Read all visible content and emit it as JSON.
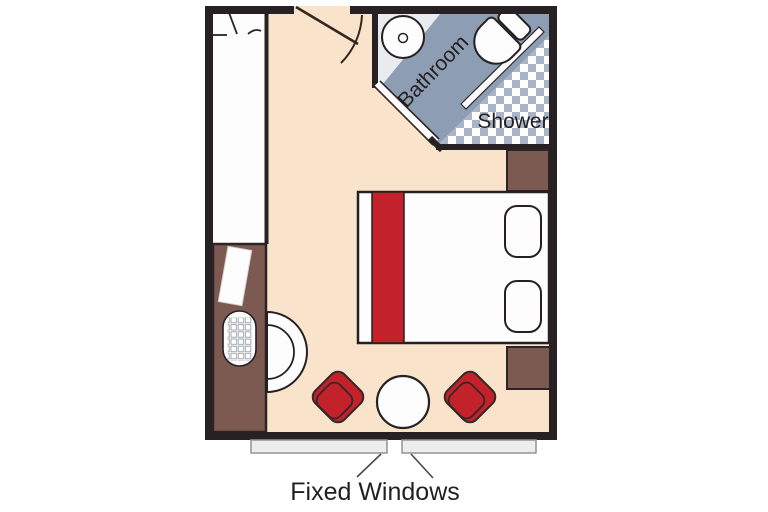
{
  "title": "Cabin floor plan",
  "labels": {
    "bathroom": "Bathroom",
    "shower": "Shower",
    "fixed_windows": "Fixed Windows"
  },
  "colors": {
    "wall": "#272123",
    "floor": "#f9e3ca",
    "furniture_brown": "#7c5a51",
    "accent_red": "#c4222a",
    "bath_band_blue": "#8d9eb4",
    "checker_blue": "#a9b4c6",
    "bath_floor": "#e9ebef",
    "window_sill": "#ededed",
    "white": "#fdfdfd"
  },
  "furniture_icons": [
    "wardrobe",
    "desk",
    "desk-chair",
    "telephone-keypad",
    "desk-accessory",
    "entry-door",
    "bathroom-door",
    "washbasin",
    "toilet",
    "shower-floor",
    "shower-glass",
    "nightstand-top",
    "nightstand-bottom",
    "double-bed",
    "bed-runner",
    "pillow",
    "armchair-left",
    "armchair-right",
    "round-table",
    "fixed-window-left",
    "fixed-window-right"
  ]
}
